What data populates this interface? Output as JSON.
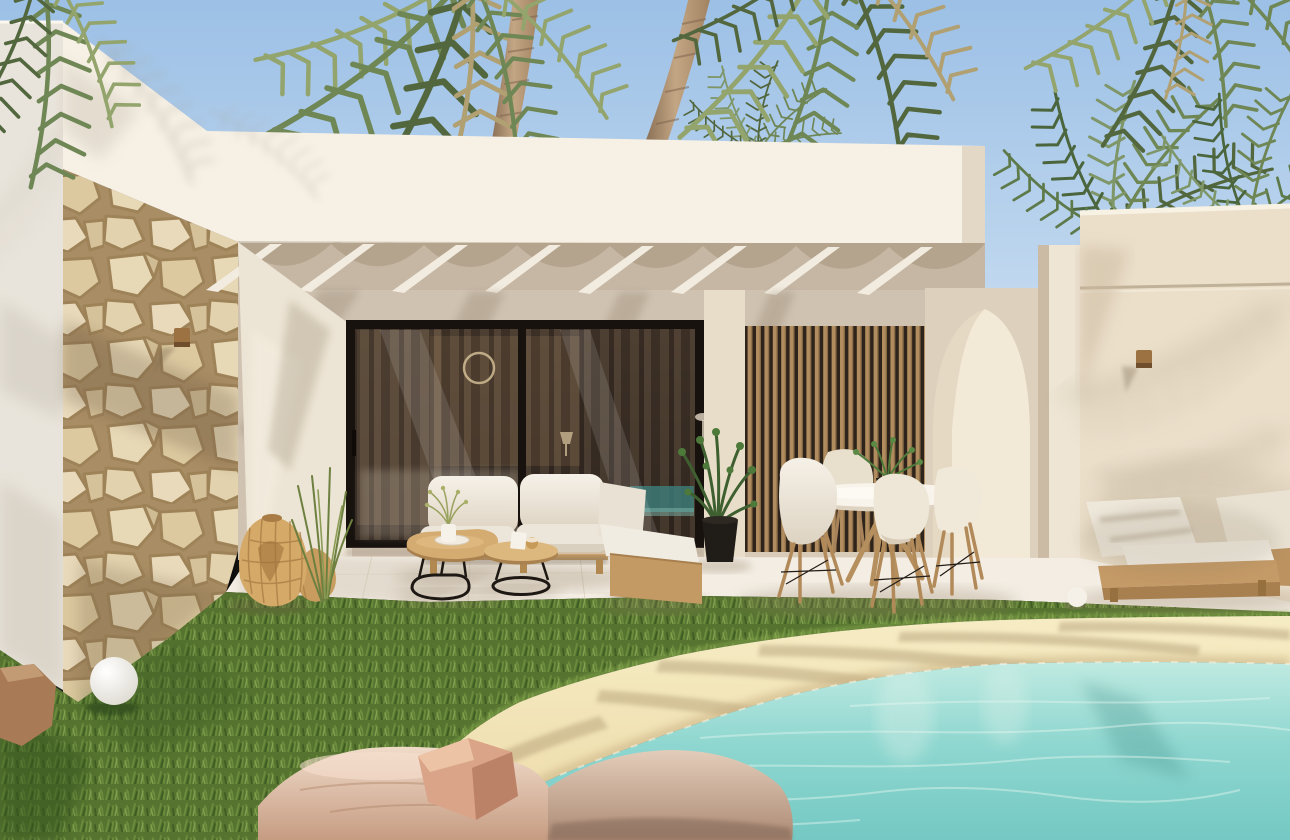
{
  "scene": {
    "type": "architectural-exterior-render",
    "setting": "Photorealistic midday render of a modern Mediterranean villa with covered terrace and sand-edged pool",
    "objects": [
      "sky",
      "palm-canopy",
      "palm-trunks",
      "left-white-wall",
      "stone-clad-pillar",
      "roof-fascia",
      "pergola-rafters",
      "patio-back-wall",
      "sliding-glass-door",
      "curtain-reflection",
      "pool-reflection",
      "timber-slat-screen",
      "pointed-arch-doorway",
      "corner-column",
      "right-building-wall",
      "wall-sconce",
      "outdoor-sofa",
      "chaise-module",
      "nesting-coffee-tables",
      "flower-vase",
      "candle",
      "potted-palm",
      "round-dining-table",
      "shell-dining-chairs",
      "table-plant",
      "sun-loungers",
      "side-cube-table",
      "rattan-lanterns",
      "sphere-floor-lamp",
      "ornamental-grass",
      "lawn",
      "terrace-floor",
      "pool-sand-beach",
      "pool-water",
      "boulders",
      "white-pebble"
    ]
  },
  "palette": {
    "sky_top": "#9cc0e6",
    "sky_horizon": "#d8e7f4",
    "fascia": "#f6f0e5",
    "fascia_shade": "#cfc2ae",
    "left_wall": "#e9e4db",
    "stone_joint": "#a98d64",
    "stone_face": "#e7d8b6",
    "patio_wall": "#cfc2b0",
    "pergola_shade": "#b3a28c",
    "rafter": "#f2ece0",
    "patio_left_wall": "#ece4d4",
    "door_frame": "#17120e",
    "glass": "#241d17",
    "curtain": "#75604b",
    "slat_wood": "#b08c5e",
    "slat_gap": "#2e241b",
    "arch_wall": "#ddd0bc",
    "arch_inner": "#f3e9d7",
    "column": "#eee5d4",
    "right_wall": "#ebdfca",
    "sconce": "#9c7243",
    "floor": "#f3ede3",
    "floor_shadow": "#8f7a5f",
    "grass": "#567430",
    "grass_dark": "#32511c",
    "grass_light": "#86a84e",
    "sand_light": "#f6ecc4",
    "sand": "#ecdaa8",
    "sand_wet": "#c9b183",
    "water_edge": "#bfeae1",
    "water": "#8fd7d0",
    "water_deep": "#74c8c3",
    "rock_light": "#f0dbc9",
    "rock": "#dcb9a2",
    "rock_dark": "#b88c72",
    "wood": "#c9a06a",
    "wood_dark": "#a87f4f",
    "cushion": "#f1ece2",
    "cushion_shade": "#d8cfc0",
    "metal_black": "#1d1814",
    "lantern": "#d5a967",
    "plant": "#4d7a3a",
    "plant_dark": "#3e6030",
    "palm_green": "#6f8655",
    "palm_dark": "#53673f",
    "palm_light": "#93a46d",
    "palm_dry": "#b0a072",
    "trunk": "#bb9d7c",
    "trunk_dark": "#8c7157"
  }
}
